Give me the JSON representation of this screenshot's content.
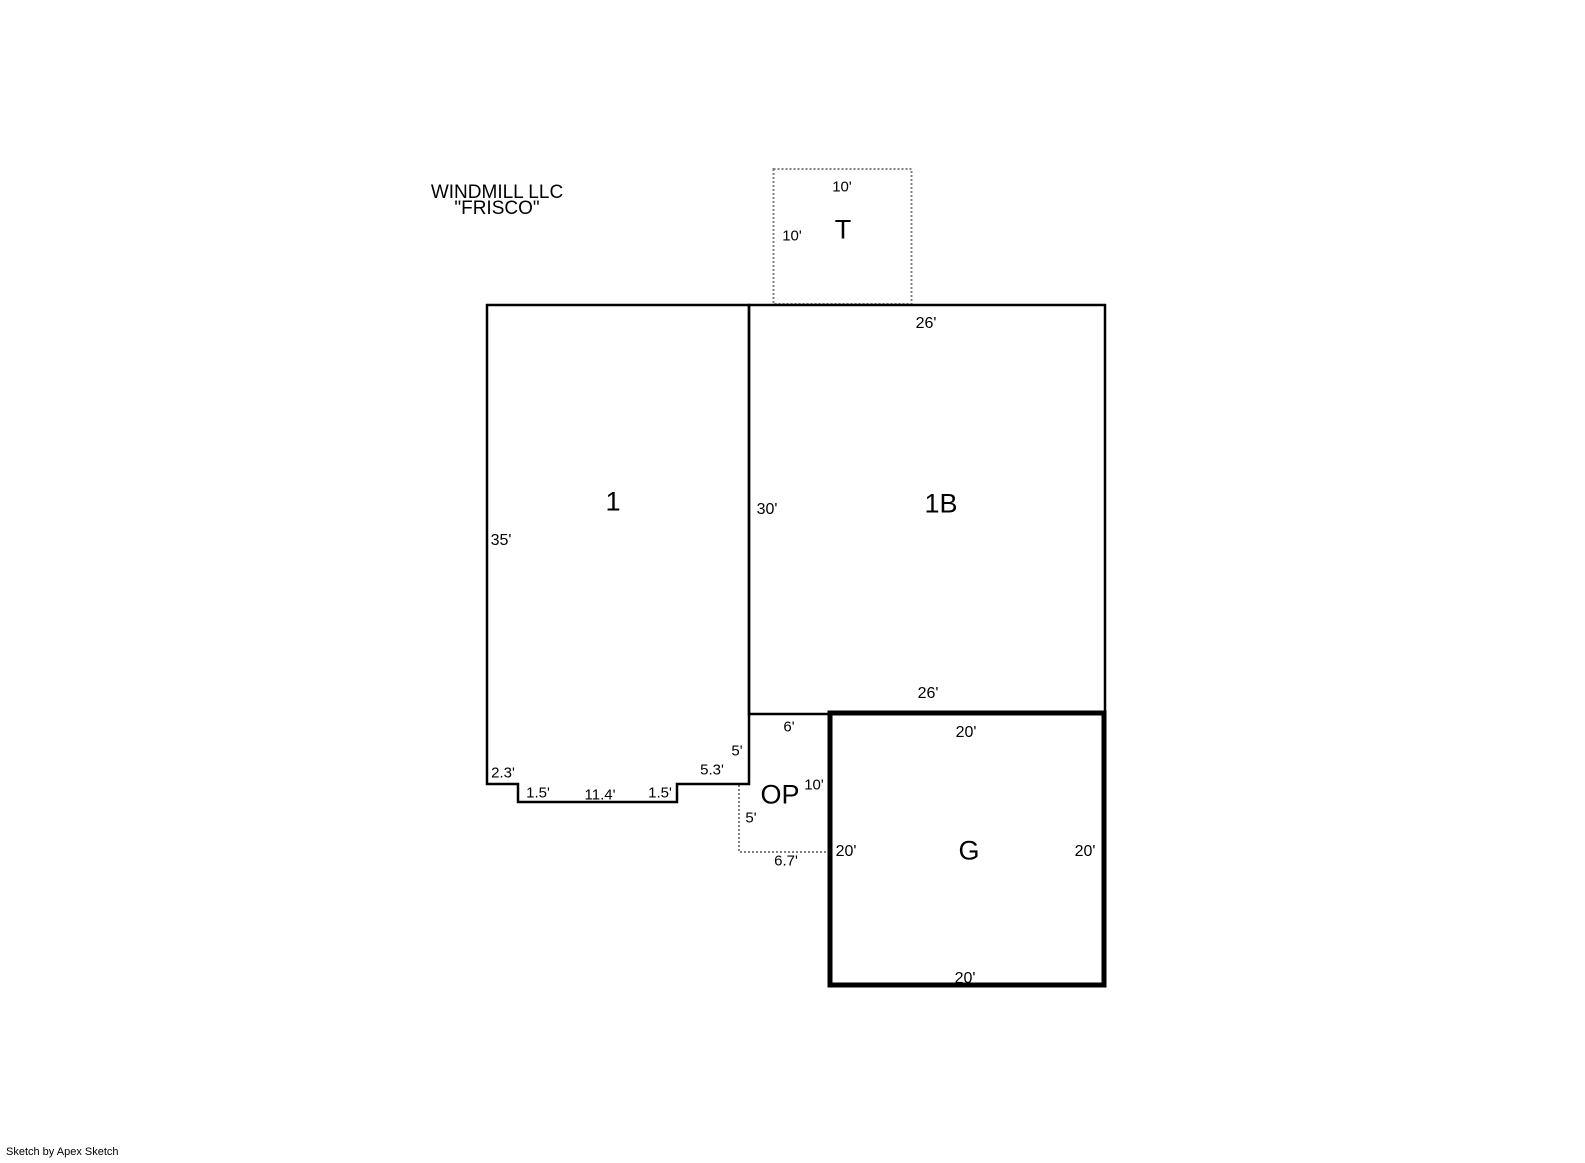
{
  "title": {
    "line1": "WINDMILL LLC",
    "line2": "\"FRISCO\""
  },
  "footer": {
    "credit": "Sketch by Apex Sketch"
  },
  "colors": {
    "line": "#000000",
    "dashed_line": "#808080",
    "background": "#ffffff"
  },
  "units": {
    "t": {
      "label": "T",
      "dim_top": "10'",
      "dim_left": "10'"
    },
    "one": {
      "label": "1",
      "dim_left": "35'",
      "dim_seg1": "2.3'",
      "dim_seg2": "1.5'",
      "dim_seg3": "11.4'",
      "dim_seg4": "1.5'",
      "dim_seg5": "5.3'",
      "dim_seg6": "5'"
    },
    "one_b": {
      "label": "1B",
      "dim_top": "26'",
      "dim_left": "30'",
      "dim_bottom": "26'"
    },
    "op": {
      "label": "OP",
      "dim_top": "6'",
      "dim_right": "10'",
      "dim_left": "5'",
      "dim_bottom": "6.7'"
    },
    "g": {
      "label": "G",
      "dim_top": "20'",
      "dim_left": "20'",
      "dim_right": "20'",
      "dim_bottom": "20'"
    }
  }
}
